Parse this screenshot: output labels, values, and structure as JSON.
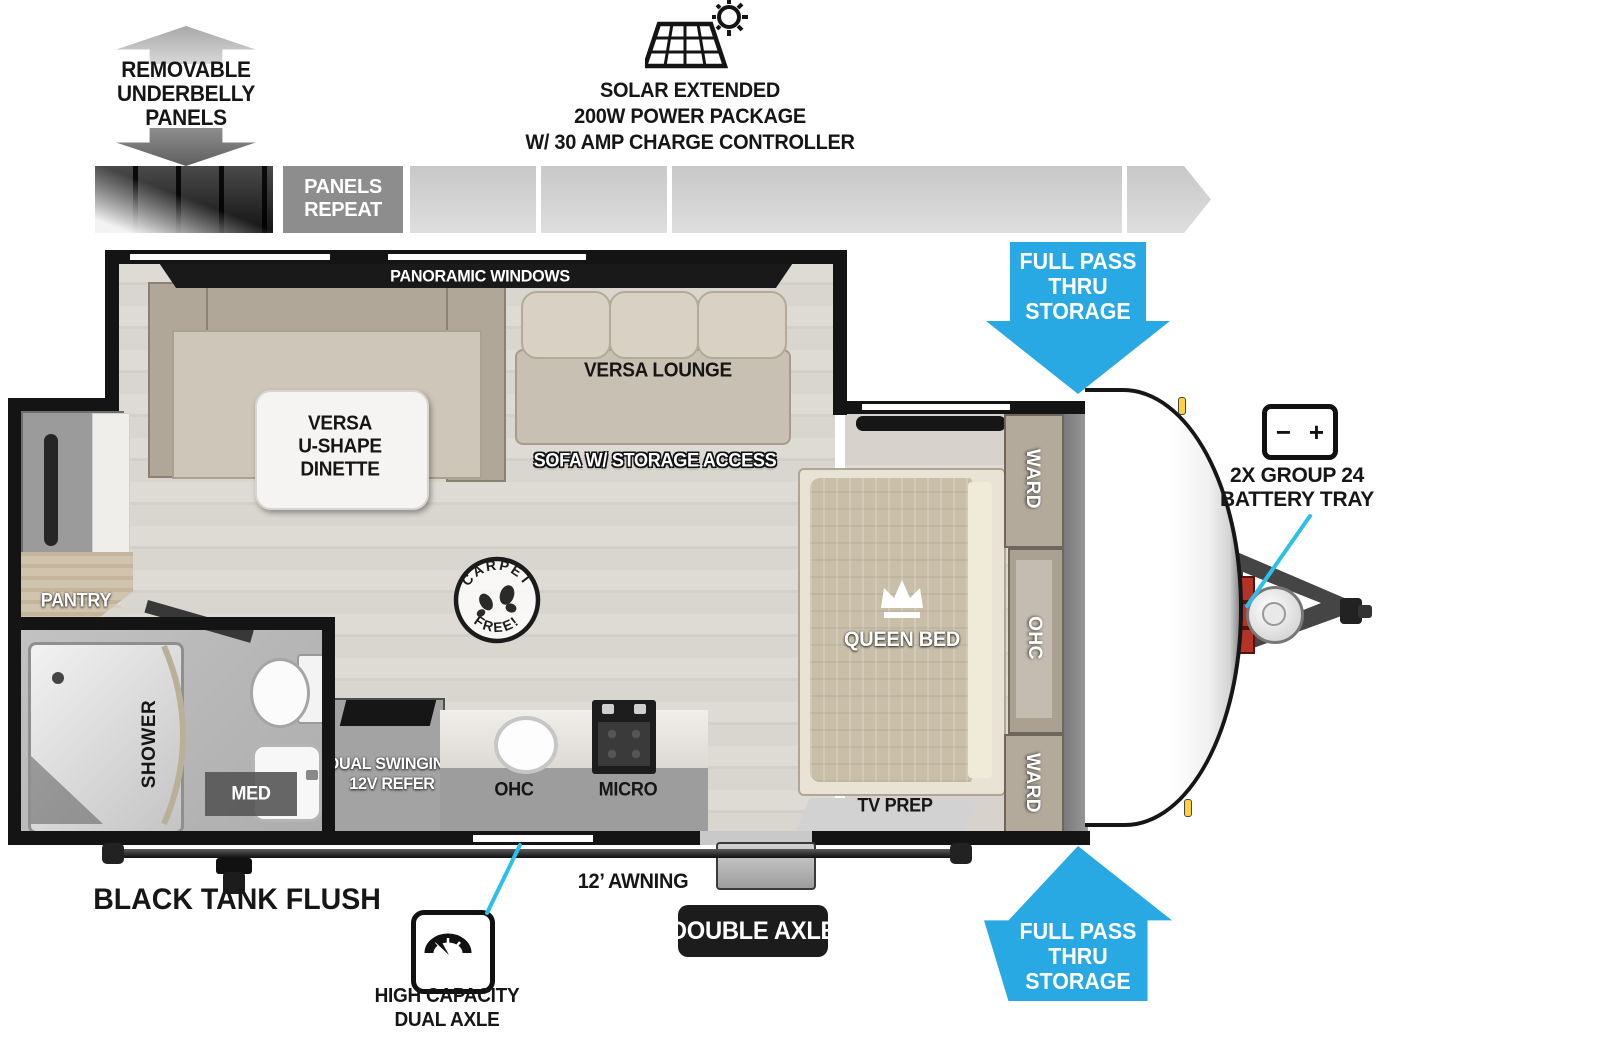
{
  "legend": {
    "underbelly_label": "REMOVABLE\nUNDERBELLY\nPANELS",
    "panels_repeat": "PANELS\nREPEAT",
    "solar_label": "SOLAR EXTENDED\n200W POWER PACKAGE\nW/ 30 AMP CHARGE CONTROLLER"
  },
  "callouts": {
    "full_pass_thru_top": "FULL PASS\nTHRU\nSTORAGE",
    "full_pass_thru_bottom": "FULL PASS\nTHRU\nSTORAGE",
    "battery_tray": "2X GROUP 24\nBATTERY TRAY",
    "battery_minus": "−",
    "battery_plus": "+",
    "black_tank_flush": "BLACK TANK FLUSH",
    "high_capacity": "HIGH CAPACITY\nDUAL AXLE",
    "double_axle": "DOUBLE AXLE",
    "awning": "12’ AWNING"
  },
  "floorplan": {
    "panoramic_windows": "PANORAMIC WINDOWS",
    "versa_lounge": "VERSA LOUNGE",
    "versa_dinette": "VERSA\nU-SHAPE\nDINETTE",
    "sofa_storage": "SOFA W/ STORAGE ACCESS",
    "queen_bed": "QUEEN BED",
    "ward_top": "WARD",
    "ward_bottom": "WARD",
    "ohc_bedroom": "OHC",
    "tv_prep": "TV PREP",
    "pantry": "PANTRY",
    "shower": "SHOWER",
    "med": "MED",
    "refer": "DUAL SWINGING\n12V REFER",
    "ohc_kitchen": "OHC",
    "micro": "MICRO",
    "carpet_free_top": "CARPET",
    "carpet_free_bottom": "FREE!"
  },
  "colors": {
    "accent_blue": "#29a9e4",
    "callout_cyan": "#2bc0ea"
  }
}
